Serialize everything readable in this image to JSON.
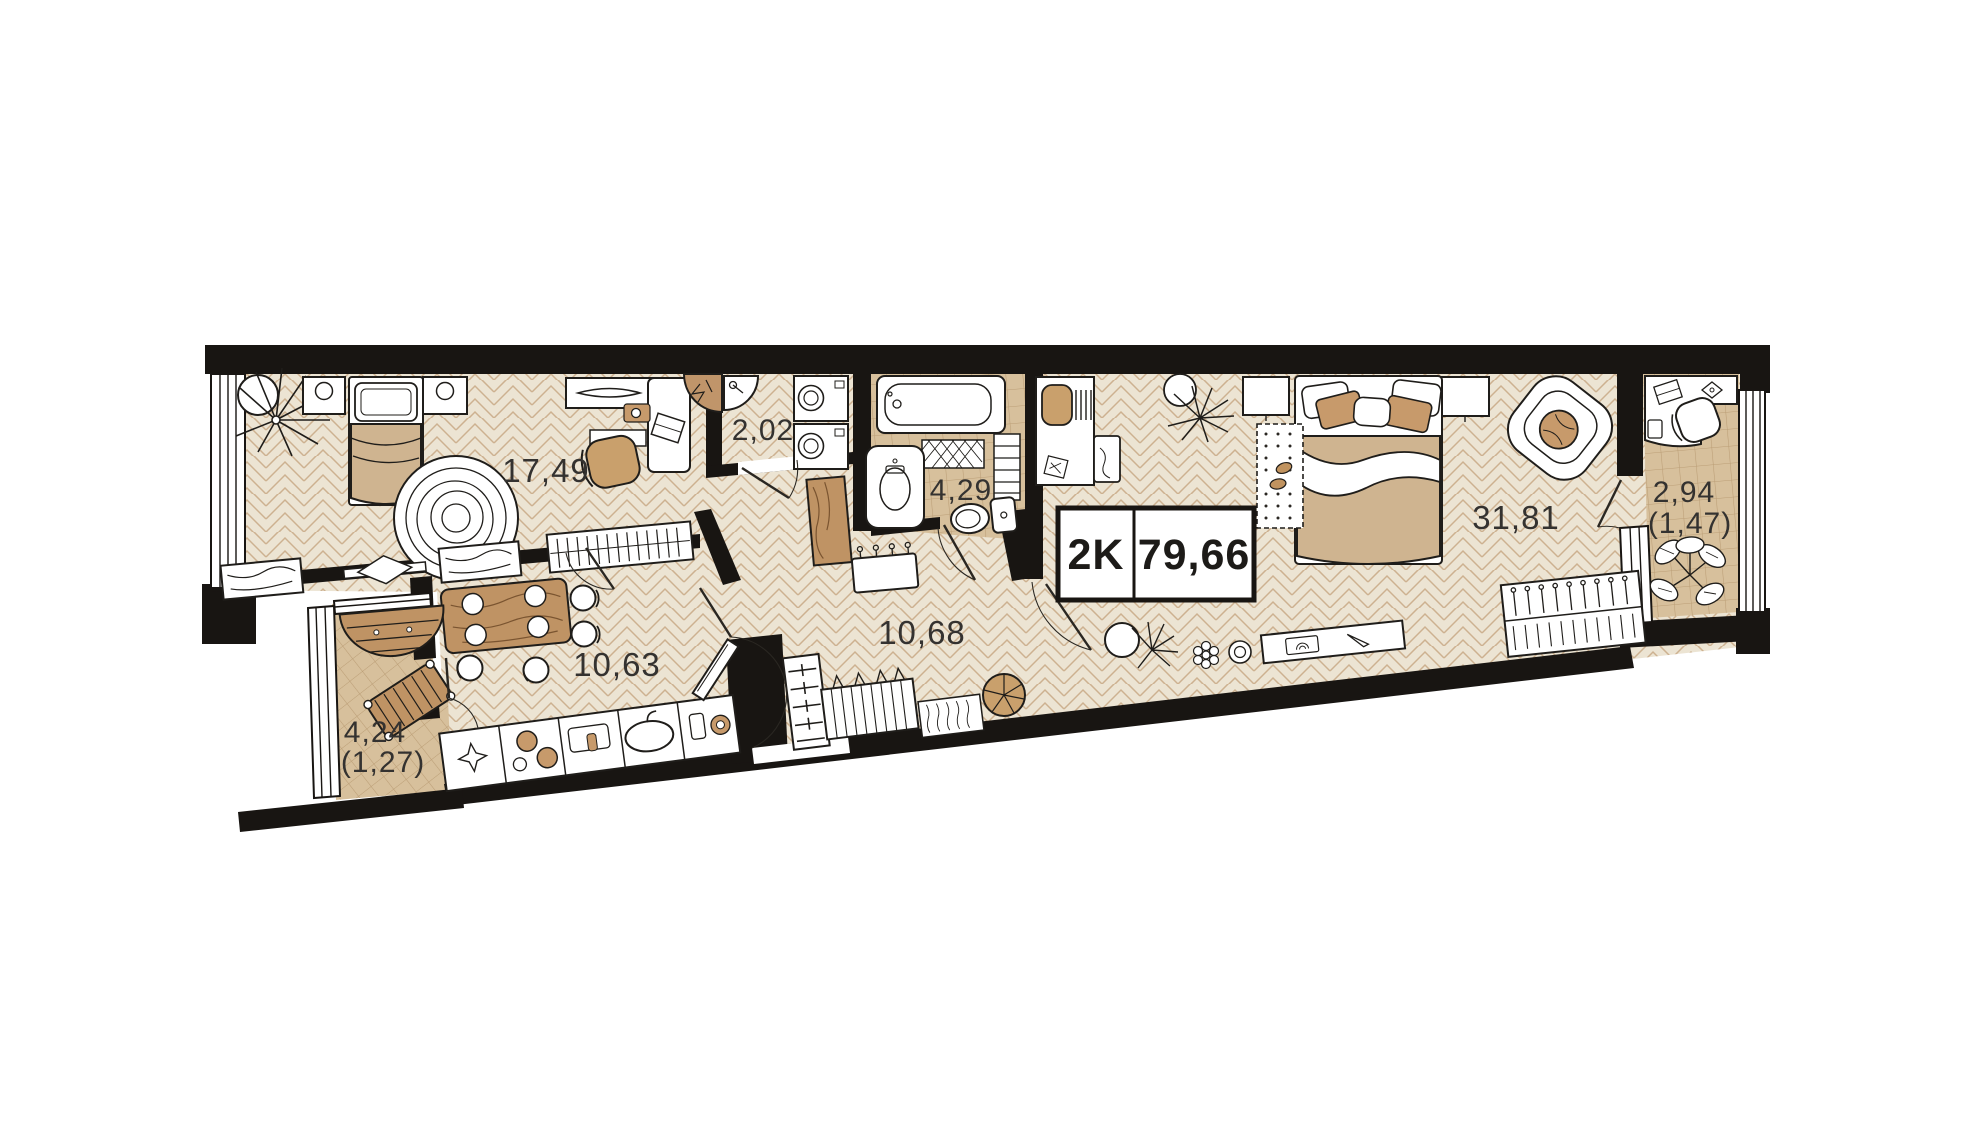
{
  "plan": {
    "badge": {
      "type": "2K",
      "total_area": "79,66"
    },
    "rooms": [
      {
        "id": "bedroom",
        "area": "17,49"
      },
      {
        "id": "laundry-closet",
        "area": "2,02"
      },
      {
        "id": "bathroom",
        "area": "4,29"
      },
      {
        "id": "kitchen-dining",
        "area": "10,63"
      },
      {
        "id": "hallway",
        "area": "10,68"
      },
      {
        "id": "living-bedroom",
        "area": "31,81"
      },
      {
        "id": "loggia-right",
        "area": "2,94",
        "area_reduced": "(1,47)"
      },
      {
        "id": "loggia-left",
        "area": "4,24",
        "area_reduced": "(1,27)"
      }
    ],
    "colors": {
      "wall": "#181512",
      "floor": "#ece4d3",
      "floor_line": "#cdb190",
      "tile": "#d7c09c",
      "tile_line": "#bb9e76",
      "wood": "#bf9364",
      "wood_grain": "#7a5430",
      "tan": "#c79a6b",
      "blanket": "#cfb490",
      "label_text": "#343230"
    }
  }
}
